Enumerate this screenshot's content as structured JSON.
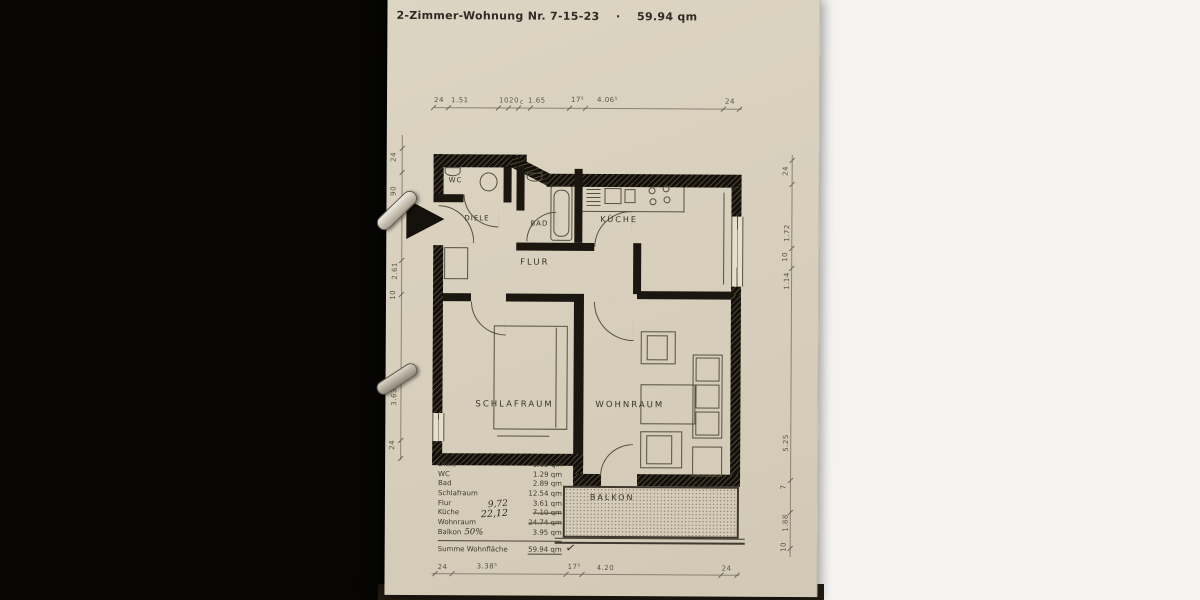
{
  "title": "2-Zimmer-Wohnung Nr. 7-15-23    ·    59.94 qm",
  "rooms": {
    "wc": "WC",
    "diele": "DIELE",
    "bad": "BAD",
    "flur": "FLUR",
    "kueche": "KÜCHE",
    "schlafraum": "SCHLAFRAUM",
    "wohnraum": "WOHNRAUM",
    "balkon": "BALKON"
  },
  "dims": {
    "top": [
      "24",
      "1.51",
      "10",
      "20",
      "c",
      "1.65",
      "17⁵",
      "4.06⁵",
      "24"
    ],
    "bottom": [
      "24",
      "3.38⁵",
      "17⁵",
      "4.20",
      "24"
    ],
    "left": [
      "24",
      "90",
      "2.61",
      "10",
      "3.63",
      "24"
    ],
    "right": [
      "24",
      "1.72",
      "10",
      "1.14",
      "5.25",
      "7",
      "1.88",
      "10"
    ]
  },
  "table": {
    "rows": [
      {
        "name": "Diele",
        "value": "3.82 qm"
      },
      {
        "name": "WC",
        "value": "1.29 qm"
      },
      {
        "name": "Bad",
        "value": "2.89 qm"
      },
      {
        "name": "Schlafraum",
        "value": "12.54 qm"
      },
      {
        "name": "Flur",
        "value": "3.61 qm"
      },
      {
        "name": "Küche",
        "value": "7.10 qm",
        "corrected": "9,72"
      },
      {
        "name": "Wohnraum",
        "value": "24.74 qm",
        "corrected": "22,12"
      },
      {
        "name": "Balkon",
        "suffix": "50%",
        "value": "3.95 qm"
      }
    ],
    "total_label": "Summe Wohnfläche",
    "total_value": "59.94 qm",
    "checkmark": "✓"
  },
  "colors": {
    "paper": "#d8d0bd",
    "wall": "#1b160f",
    "ink": "#3d382e",
    "background_left": "#070605",
    "background_right": "#f4f3f0"
  }
}
